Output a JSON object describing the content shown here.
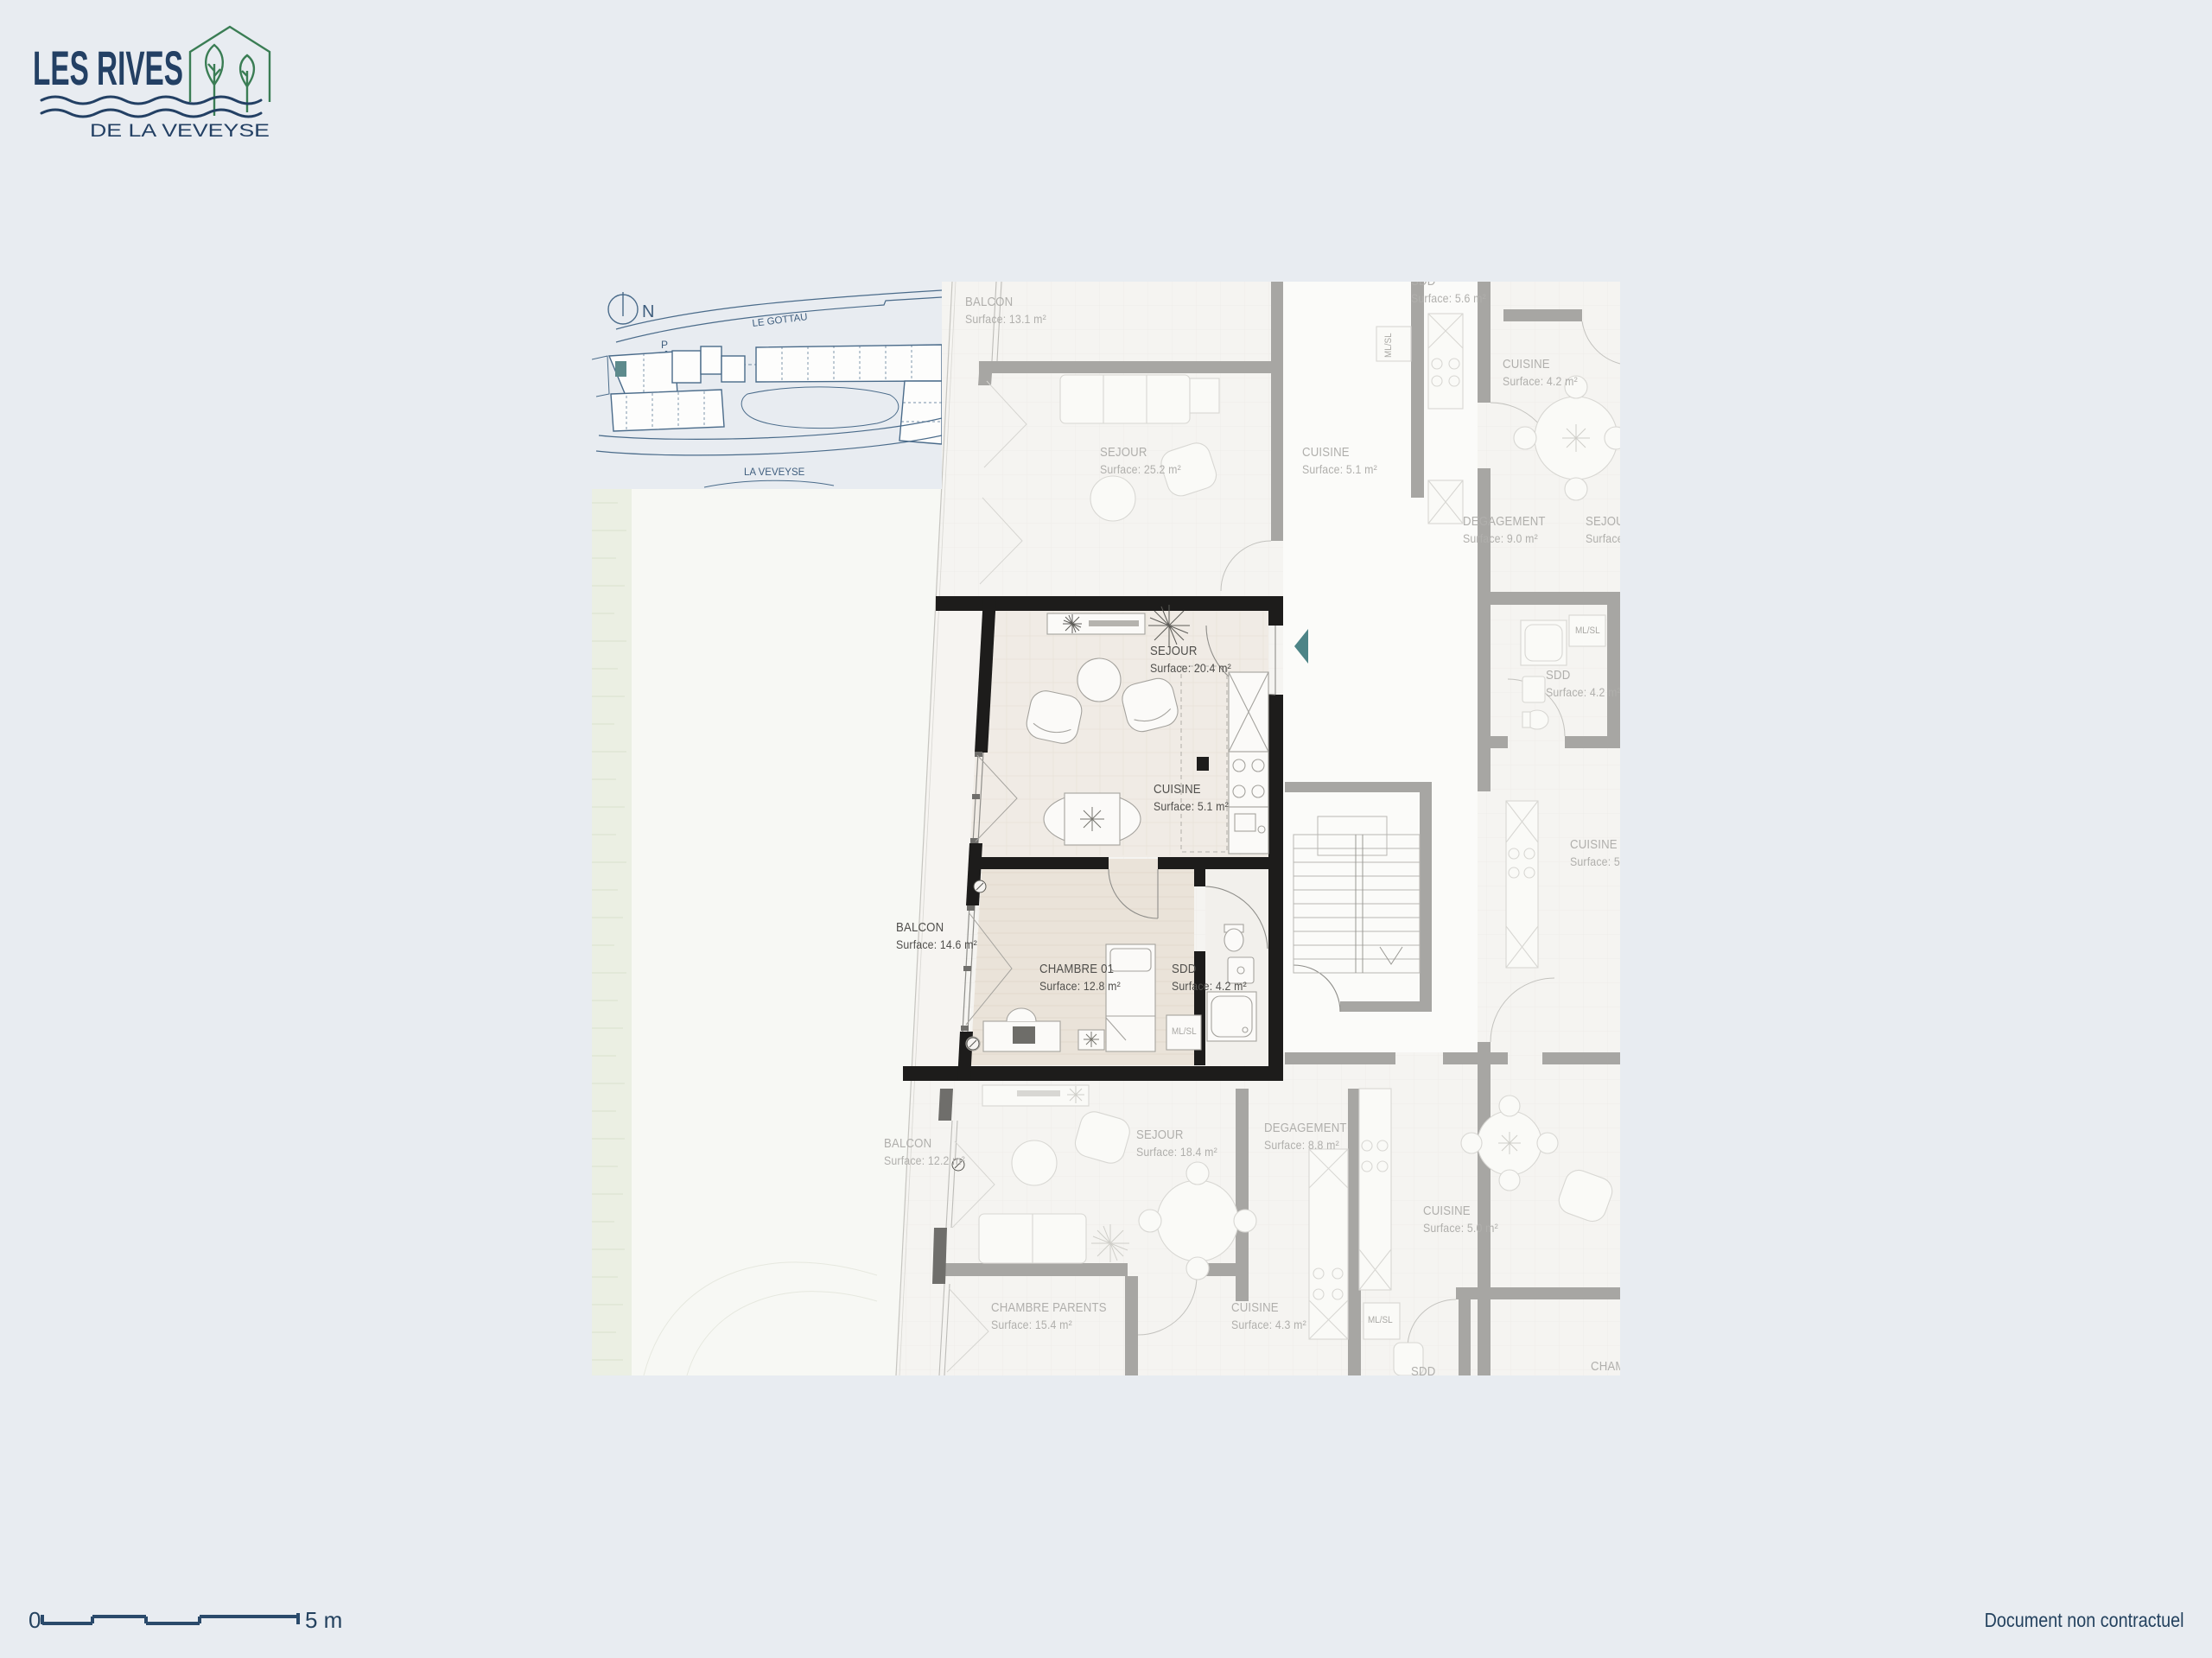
{
  "logo": {
    "title": "LES RIVES",
    "subtitle": "DE LA VEVEYSE"
  },
  "site_plan": {
    "north": "N",
    "street_top": "LE GOTTAU",
    "parking": "P",
    "river": "LA VEVEYSE"
  },
  "featured_unit": {
    "sejour": {
      "name": "SEJOUR",
      "surface": "Surface: 20.4 m²"
    },
    "cuisine": {
      "name": "CUISINE",
      "surface": "Surface: 5.1 m²"
    },
    "chambre": {
      "name": "CHAMBRE 01",
      "surface": "Surface: 12.8 m²"
    },
    "sdd": {
      "name": "SDD",
      "surface": "Surface: 4.2 m²"
    },
    "balcon": {
      "name": "BALCON",
      "surface": "Surface: 14.6 m²"
    }
  },
  "neighbors": [
    {
      "name": "BALCON",
      "surface": "Surface: 13.1 m²"
    },
    {
      "name": "SEJOUR",
      "surface": "Surface: 25.2 m²"
    },
    {
      "name": "CUISINE",
      "surface": "Surface: 5.1 m²"
    },
    {
      "name": "SDD",
      "surface": "Surface: 5.6 m²"
    },
    {
      "name": "CUISINE",
      "surface": "Surface: 4.2 m²"
    },
    {
      "name": "DEGAGEMENT",
      "surface": "Surface: 9.0 m²"
    },
    {
      "name": "SEJOUR",
      "surface": "Surface: 18.4 m²"
    },
    {
      "name": "SDD",
      "surface": "Surface: 4.2 m²"
    },
    {
      "name": "CUISINE",
      "surface": "Surface: 5.1 m²"
    },
    {
      "name": "BALCON",
      "surface": "Surface: 12.2 m²"
    },
    {
      "name": "SEJOUR",
      "surface": "Surface: 18.4 m²"
    },
    {
      "name": "CHAMBRE PARENTS",
      "surface": "Surface: 15.4 m²"
    },
    {
      "name": "CUISINE",
      "surface": "Surface: 4.3 m²"
    },
    {
      "name": "DEGAGEMENT",
      "surface": "Surface: 8.8 m²"
    },
    {
      "name": "CUISINE",
      "surface": "Surface: 5.0 m²"
    },
    {
      "name": "SDD",
      "surface": ""
    },
    {
      "name": "CHAMBRE",
      "surface": ""
    }
  ],
  "labels": {
    "ml_sl": "ML/SL"
  },
  "footer": {
    "scale_zero": "0",
    "scale_end": "5 m",
    "disclaimer": "Document non contractuel"
  },
  "colors": {
    "navy": "#234064",
    "green": "#3a7d54",
    "accent_teal": "#4d8487",
    "wall_black": "#1d1c1b",
    "wall_gray": "#a7a6a3",
    "page_bg": "#e8ecf1"
  }
}
